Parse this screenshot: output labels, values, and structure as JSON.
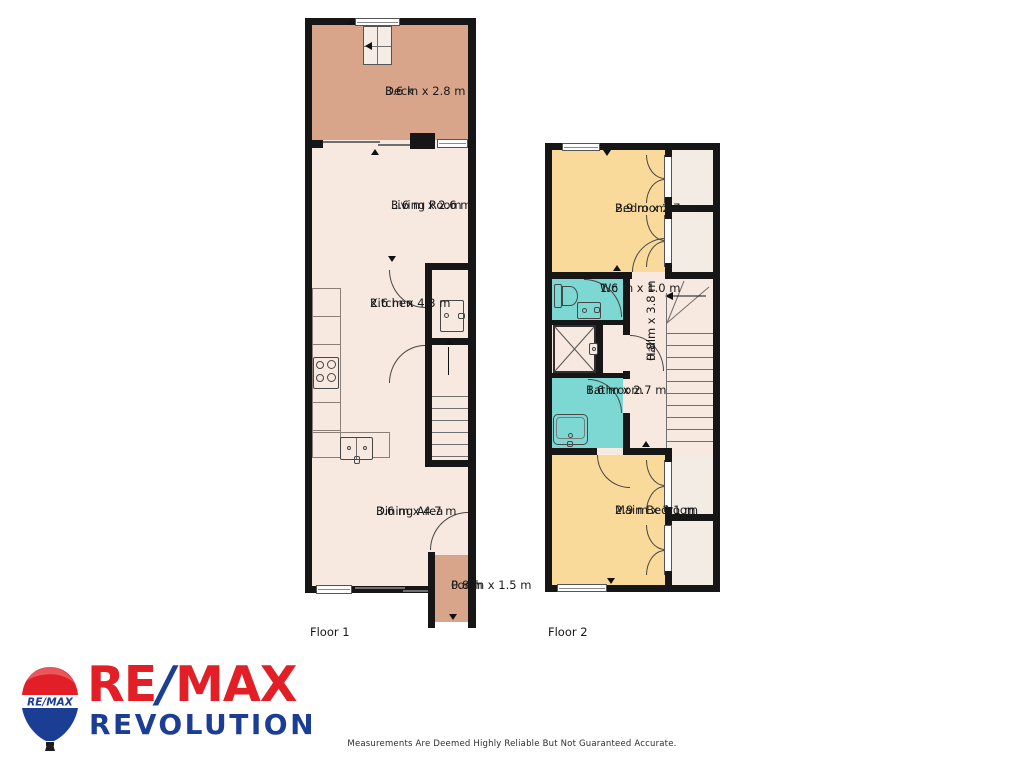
{
  "floors": [
    {
      "label": "Floor 1",
      "rooms": [
        {
          "name": "Deck",
          "dims": "3.6 m x 2.8 m"
        },
        {
          "name": "Living Room",
          "dims": "3.6 m x 2.6 m"
        },
        {
          "name": "Kitchen",
          "dims": "2.6 m x 4.3 m"
        },
        {
          "name": "Dining Area",
          "dims": "3.6 m x 4.7 m"
        },
        {
          "name": "Porch",
          "dims": "0.8 m x 1.5 m"
        }
      ]
    },
    {
      "label": "Floor 2",
      "rooms": [
        {
          "name": "Bedroom",
          "dims": "2.9 m x 2.7 m"
        },
        {
          "name": "Wc",
          "dims": "1.6 m x 1.0 m"
        },
        {
          "name": "Bathroom",
          "dims": "1.6 m x 2.7 m"
        },
        {
          "name": "Hall",
          "dims": "0.8 m x 3.8 m"
        },
        {
          "name": "Main Bedroom",
          "dims": "2.9 m x 3.1 m"
        }
      ]
    }
  ],
  "branding": {
    "balloon_text": "RE/MAX",
    "name_re": "RE",
    "name_slash": "/",
    "name_max": "MAX",
    "subtitle": "REVOLUTION"
  },
  "footer": {
    "disclaimer": "Measurements Are Deemed Highly Reliable But Not Guaranteed Accurate."
  },
  "colors": {
    "wall": "#161616",
    "floor_interior": "#f7e9e0",
    "deck": "#d8a58b",
    "bedroom": "#fada9b",
    "wet_room": "#7dd8d4",
    "closet": "#f3ece5",
    "remax_red": "#e21f26",
    "remax_blue": "#1b3e94"
  }
}
